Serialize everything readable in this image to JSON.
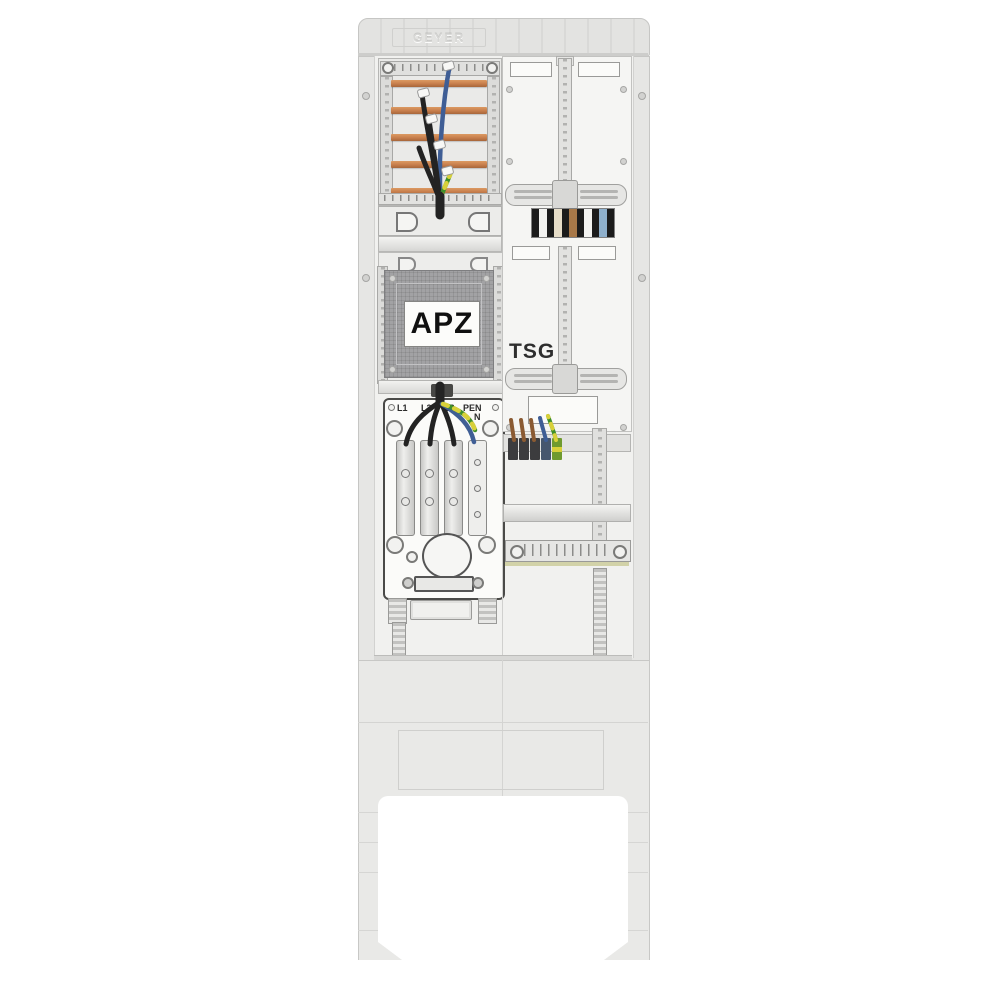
{
  "product": {
    "brand_embossed": "GEYER",
    "apz_label": "APZ",
    "tsg_label": "TSG"
  },
  "terminal_labels": {
    "l1": "L1",
    "l2": "L2",
    "l3": "L3",
    "pen": "PEN",
    "n": "N"
  },
  "colors": {
    "busbar_copper": "#c9804e",
    "wire_black": "#232323",
    "wire_blue": "#3f5e95",
    "wire_green": "#3f8f2a",
    "wire_yellow": "#d8d03a",
    "wire_brown": "#8a5a32",
    "panel_dark": "#a2a2a4",
    "enclosure_gray": "#e9e9e7"
  },
  "meter_stripe_block": {
    "stripes": [
      "#1b1b1b",
      "#f2f2f0",
      "#1b1b1b",
      "#e6ddc8",
      "#1b1b1b",
      "#a87848",
      "#1b1b1b",
      "#f2f2f0",
      "#1b1b1b",
      "#8fb0cc",
      "#1b1b1b"
    ]
  },
  "din_terminals": {
    "blocks": [
      "#3c3c3e",
      "#3c3c3e",
      "#3c3c3e",
      "#46566e",
      "#6f9a2f"
    ]
  }
}
